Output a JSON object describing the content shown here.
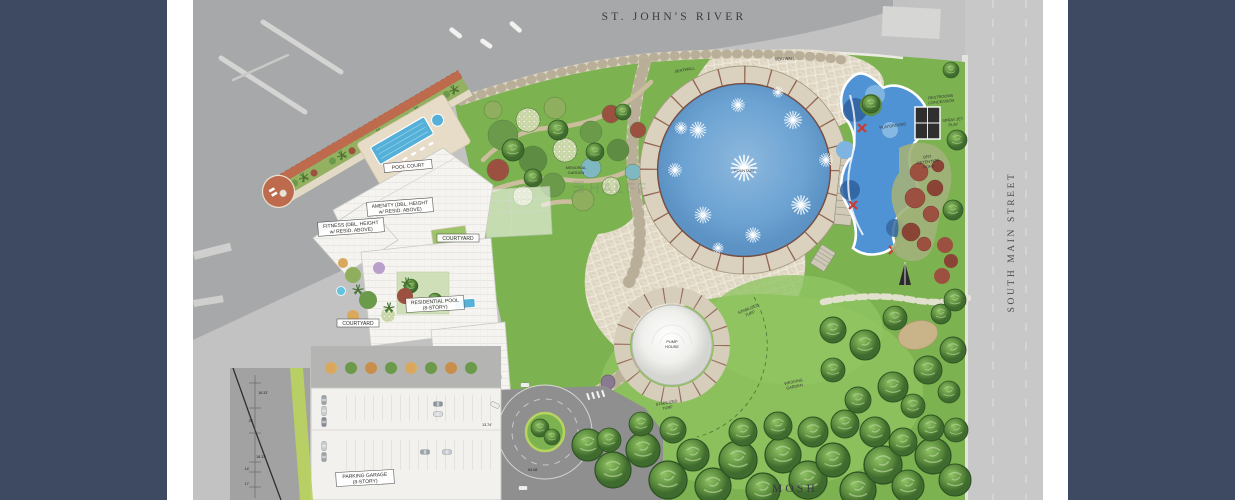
{
  "slide": {
    "frame_bar_color": "#3d4a62",
    "paper_color": "#ffffff"
  },
  "plan": {
    "river_label": "ST. JOHN'S RIVER",
    "street_label": "SOUTH MAIN STREET",
    "mosh_label": "MOSH",
    "watermark": "HALFF",
    "labels": {
      "pool_court": "POOL COURT",
      "amenity_1": "AMENITY (DBL. HEIGHT",
      "amenity_2": "w/ RESID. ABOVE)",
      "fitness_1": "FITNESS (DBL. HEIGHT",
      "fitness_2": "w/ RESID. ABOVE)",
      "residential_1": "RESIDENTIAL POOL",
      "residential_2": "(8-STORY)",
      "courtyard_upper": "COURTYARD",
      "courtyard_lower": "COURTYARD",
      "parking_1": "PARKING GARAGE",
      "parking_2": "(8-STORY)",
      "memorial_1": "MEMORIAL",
      "memorial_2": "GARDEN",
      "seatwall_1": "SEATWALL",
      "seatwall_2": "SEATWALL",
      "fountain": "FOUNTAIN",
      "pump_1": "PUMP",
      "pump_2": "HOUSE",
      "stabilized_1a": "STABILIZED",
      "stabilized_1b": "TURF",
      "stabilized_2a": "STABILIZED",
      "stabilized_2b": "TURF",
      "wedding_1": "WEDDING",
      "wedding_2": "GARDEN",
      "playground": "PLAYGROUND",
      "restrooms_1": "RESTROOMS",
      "restrooms_2": "CONCESSION",
      "spray_1": "SPRAY JET",
      "spray_2": "PLAY",
      "dry_1": "DRY",
      "dry_2": "RETENTION",
      "dry_3": "POND"
    },
    "dimensions": [
      "18.33'",
      "26'",
      "18.33'",
      "14'",
      "17'",
      "13.74'",
      "84.08'"
    ],
    "colors": {
      "park_green": "#7cb350",
      "lawn_green": "#8cc05c",
      "fountain_water": "#6ca3d3",
      "playground_water": "#4f93d4",
      "paving_tan": "#ddd5c2",
      "promenade_brick": "#bd6b4c",
      "aerial_gray": "#c2c2c3"
    }
  }
}
